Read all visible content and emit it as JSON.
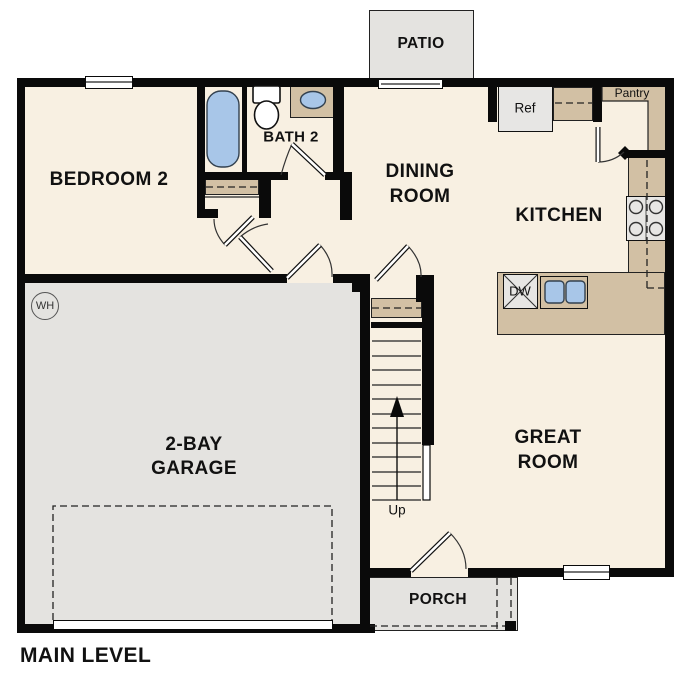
{
  "title": "MAIN LEVEL",
  "colors": {
    "wall": "#0a0a0a",
    "cream": "#f8f0e2",
    "tan": "#d2c0a4",
    "slab": "#e4e3e0",
    "appliance": "#e7e6e4",
    "blue": "#a8c6e8"
  },
  "rooms": {
    "patio": {
      "label": "PATIO"
    },
    "bedroom2": {
      "label": "BEDROOM 2"
    },
    "bath2": {
      "label": "BATH 2"
    },
    "dining": {
      "line1": "DINING",
      "line2": "ROOM"
    },
    "kitchen": {
      "label": "KITCHEN"
    },
    "garage": {
      "line1": "2-BAY",
      "line2": "GARAGE"
    },
    "great": {
      "line1": "GREAT",
      "line2": "ROOM"
    },
    "porch": {
      "label": "PORCH"
    }
  },
  "fixtures": {
    "ref": {
      "label": "Ref"
    },
    "pantry": {
      "label": "Pantry"
    },
    "dw": {
      "label": "DW"
    },
    "wh": {
      "label": "WH"
    },
    "stairs": {
      "direction_label": "Up"
    }
  }
}
